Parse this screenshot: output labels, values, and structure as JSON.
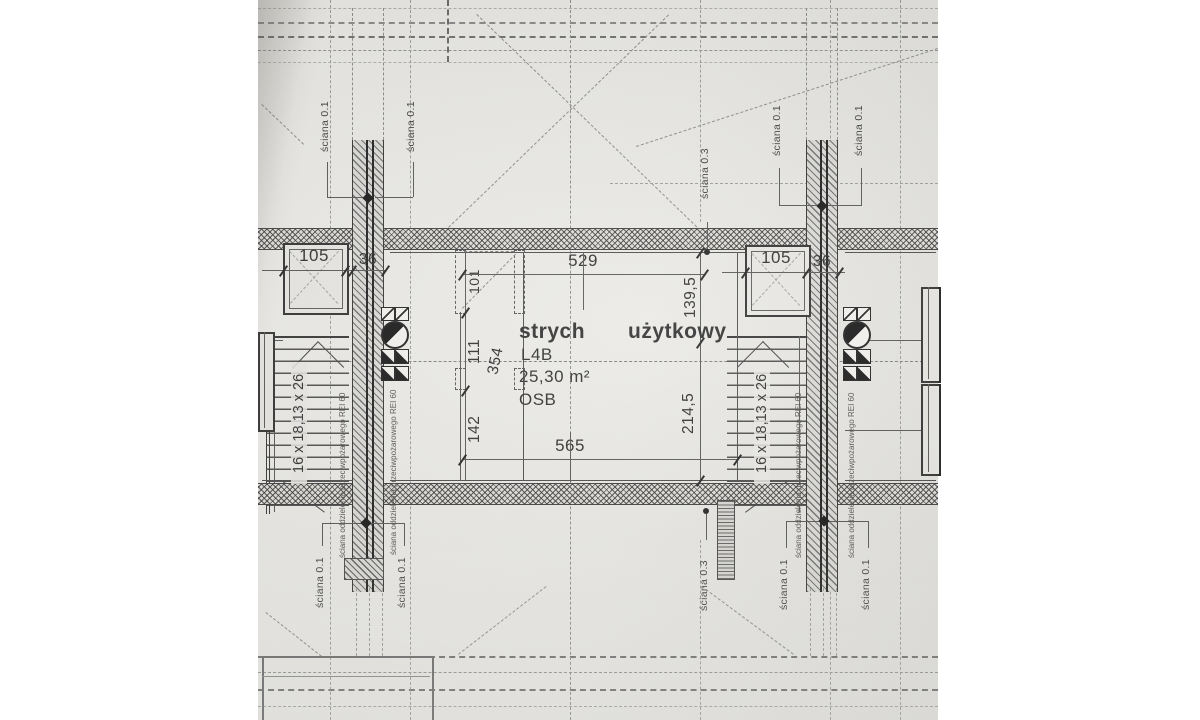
{
  "drawing": {
    "room": {
      "name_1": "strych",
      "name_2": "użytkowy",
      "unit": "L4B",
      "area": "25,30 m²",
      "floor": "OSB"
    },
    "dims": {
      "top": "529",
      "bottom": "565",
      "right_upper": "139,5",
      "right_lower": "214,5",
      "left_upper": "111",
      "left_total": "354",
      "left_lower": "142",
      "window": "101",
      "chimney": "105",
      "wall": "36"
    },
    "stairs": {
      "spec": "16 x 18,13 x 26"
    },
    "walls": {
      "w01": "ściana 0.1",
      "w03": "ściana 0.3",
      "fire": "ściana oddzielenia przeciwpożarowego REI 60"
    },
    "colors": {
      "paper": "#e9e8e5",
      "line": "#4a4a4a",
      "text": "#2d2d2d"
    }
  }
}
